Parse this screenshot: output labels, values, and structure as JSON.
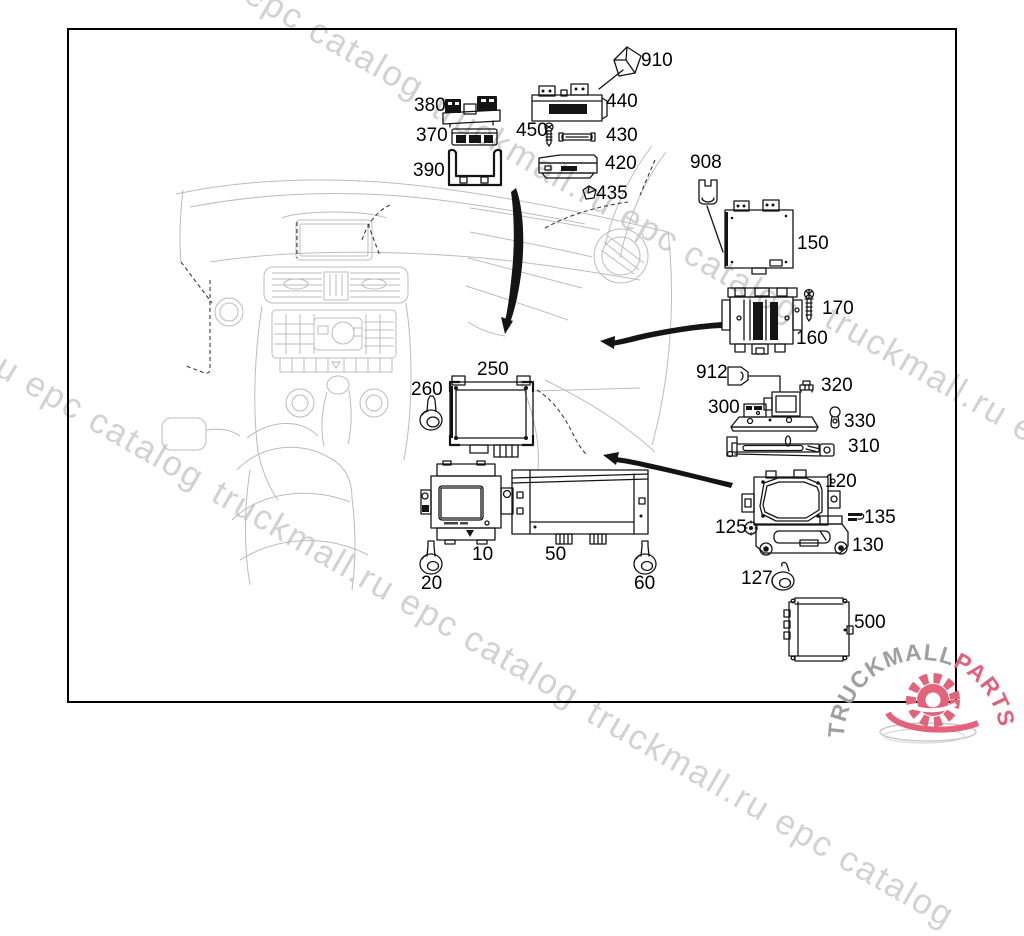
{
  "watermark": {
    "text": "truckmall.ru epc catalog",
    "color": "#d2d2d2"
  },
  "logo": {
    "brand_gray": "TRUCKMALL",
    "brand_pink": "PARTS",
    "gray_color": "#a0a0a0",
    "pink_color": "#e2607a"
  },
  "diagram": {
    "border_color": "#000000",
    "part_labels": [
      "910",
      "380",
      "440",
      "370",
      "450",
      "430",
      "390",
      "420",
      "435",
      "908",
      "150",
      "170",
      "160",
      "912",
      "320",
      "300",
      "330",
      "310",
      "250",
      "260",
      "10",
      "50",
      "20",
      "60",
      "120",
      "135",
      "125",
      "130",
      "127",
      "500"
    ]
  }
}
